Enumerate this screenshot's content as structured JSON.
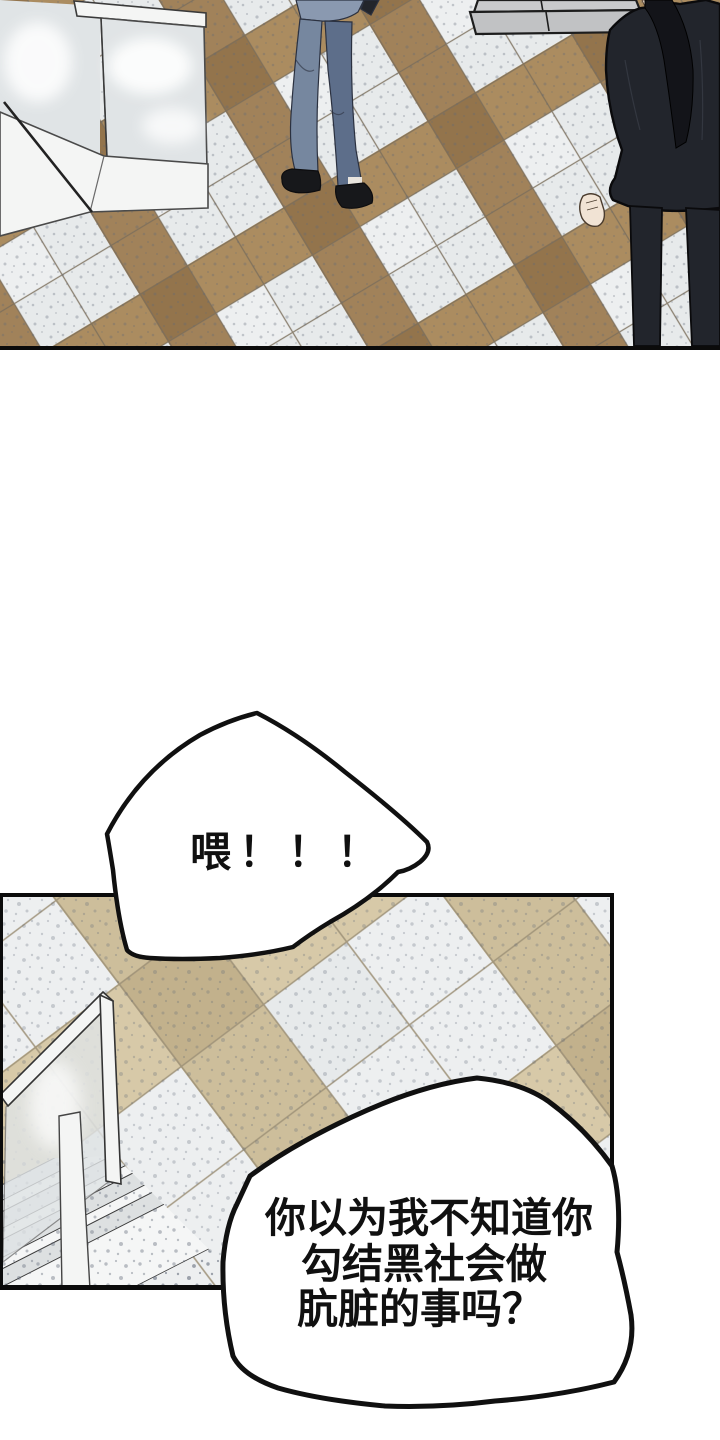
{
  "page": {
    "kind": "comic-page",
    "background": "#ffffff"
  },
  "speech_bubbles": [
    {
      "name": "bubble-hey",
      "text": "喂！！！"
    },
    {
      "name": "bubble-accusation",
      "lines": [
        "你以为我不知道你",
        "勾结黑社会做",
        "肮脏的事吗？"
      ]
    }
  ],
  "scene": {
    "top_panel_elements": [
      "glass-display-case",
      "stone-pedestal",
      "person-blue-suit-walking",
      "person-black-suit-standing",
      "diagonal-checker-tile-floor"
    ],
    "bottom_panel_elements": [
      "glass-stair-railing",
      "staircase",
      "diagonal-checker-tile-floor"
    ]
  },
  "colors": {
    "ink": "#101010",
    "panel_border": "#0b0b0b",
    "bubble_fill": "#ffffff",
    "tile_white": "#e7eaeb",
    "tile_white2": "#edeff0",
    "tile_tan": "#ab8c60",
    "tile_tan2": "#a1825a",
    "tile_tan_dark": "#93744c",
    "grout": "#7c6f5c",
    "tile_cream": "#d7c9a8",
    "tile_cream2": "#cdbe9b",
    "tile_cream_dark": "#c2b18c",
    "grout_light": "#9e9178",
    "speckle": "#5f6877",
    "glass": "#e0e4e6",
    "white_structure": "#f4f5f4",
    "suit_blue": "#8a99b0",
    "suit_blue_dark": "#76879f",
    "suit_blue_deep": "#5d6e8a",
    "shoe_black": "#17181b",
    "suit_black": "#22252c",
    "hair_black": "#131419",
    "skin": "#f1e3d4",
    "stair_tread": "#dde0e1",
    "stair_riser": "#f5f6f6",
    "line_gray": "#3f4448"
  }
}
